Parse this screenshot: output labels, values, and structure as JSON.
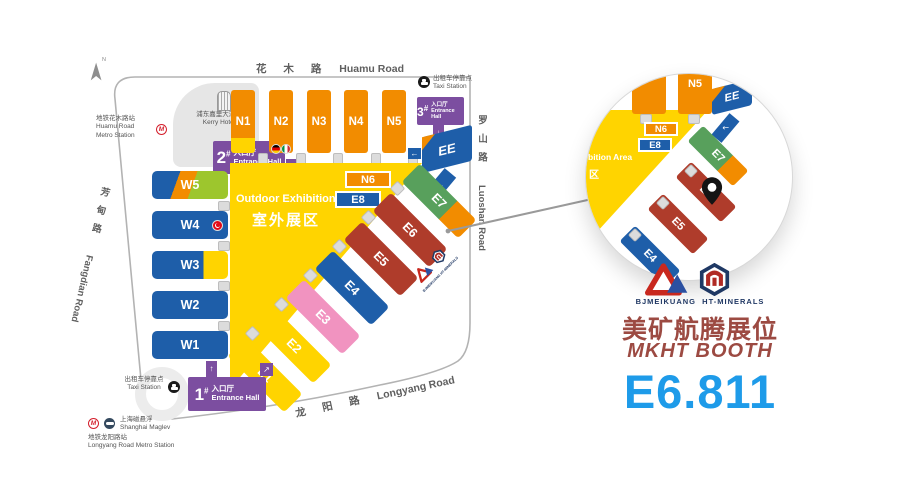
{
  "compass": "N",
  "icons": {
    "up": "↑",
    "down": "↓",
    "left": "←",
    "right": "→",
    "down_left": "↙",
    "up_right": "↗",
    "metro_m": "M"
  },
  "roads": {
    "huamu_zh": "花 木 路",
    "huamu_en": "Huamu Road",
    "luoshan_zh": "罗山路",
    "luoshan_en": "Luoshan Road",
    "fangdian_zh": "芳甸路",
    "fangdian_en": "Fangdian Road",
    "longyang_zh": "龙 阳 路",
    "longyang_en": "Longyang Road"
  },
  "halls": {
    "north": [
      "N1",
      "N2",
      "N3",
      "N4",
      "N5"
    ],
    "west": [
      "W5",
      "W4",
      "W3",
      "W2",
      "W1"
    ],
    "east": [
      "E1",
      "E2",
      "E3",
      "E4",
      "E5",
      "E6",
      "E7"
    ],
    "ee": "EE",
    "n6": "N6",
    "e8": "E8"
  },
  "outdoor_area": {
    "en": "Outdoor Exhibition Area",
    "zh": "室外展区"
  },
  "entrances": {
    "hall1": {
      "num": "1",
      "sup": "#",
      "zh": "入口厅",
      "en": "Entrance Hall"
    },
    "hall2": {
      "num": "2",
      "sup": "#",
      "zh": "入口厅",
      "en": "Entrance Hall"
    },
    "hall3": {
      "num": "3",
      "sup": "#",
      "zh": "入口厅",
      "en": "Entrance Hall"
    }
  },
  "pois": {
    "kerry_zh": "浦东嘉里大酒店",
    "kerry_en": "Kerry Hotel",
    "huamu_metro_zh": "地铁花木路站",
    "huamu_metro_en1": "Huamu Road",
    "huamu_metro_en2": "Metro Station",
    "taxi_zh": "出租车停靠点",
    "taxi_en": "Taxi Station",
    "maglev_zh": "上海磁悬浮",
    "maglev_en": "Shanghai Maglev",
    "longyang_metro_zh": "地铁龙阳路站",
    "longyang_metro_en": "Longyang Road Metro Station"
  },
  "magnifier": {
    "n5": "N5",
    "ee": "EE",
    "n6": "N6",
    "e8": "E8",
    "e7": "E7",
    "e6": "E6",
    "e5": "E5",
    "e4": "E4",
    "area_en": "bition Area",
    "area_zh": "区"
  },
  "panel": {
    "logo_left": "BJMEIKUANG",
    "logo_right": "HT-MINERALS",
    "booth_zh": "美矿航腾展位",
    "booth_en": "MKHT  BOOTH",
    "booth_no": "E6.811"
  },
  "colors": {
    "orange": "#F28C00",
    "yellow": "#FFD400",
    "hall_blue": "#1E5EA9",
    "green": "#58A05C",
    "lime": "#9DC62D",
    "dark_red": "#AF3C2B",
    "pink": "#F193C0",
    "purple": "#7C4EA0",
    "booth_blue": "#1E9BE9",
    "maroon": "#9C4A42",
    "road_gray": "#B3B3B3"
  }
}
